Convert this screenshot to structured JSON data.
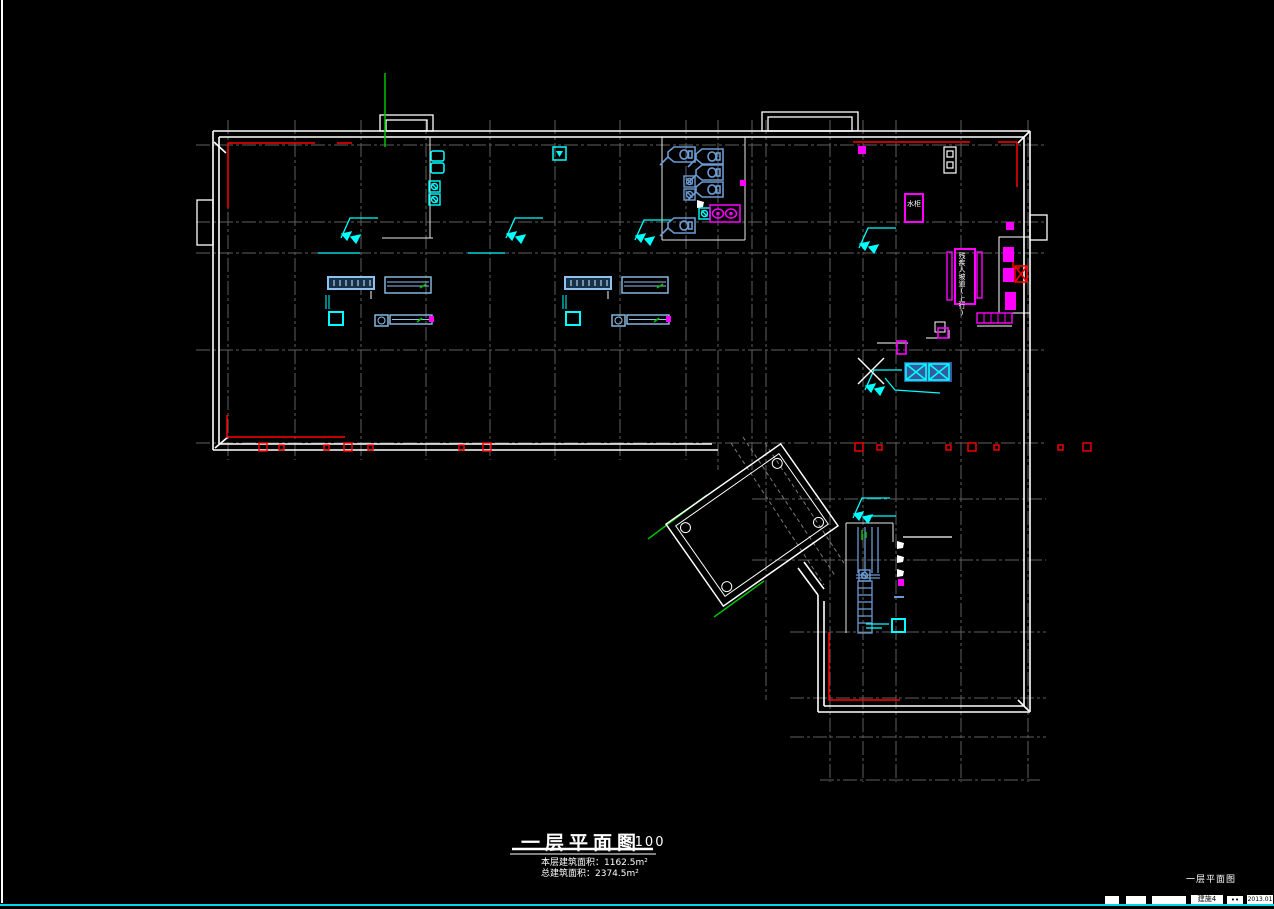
{
  "viewport": {
    "background": "#000000"
  },
  "plan": {
    "title": "一层平面图",
    "scale": "1:100",
    "area_line1": "本层建筑面积：1162.5m²",
    "area_line2": "总建筑面积：2374.5m²",
    "ramp_label": "残疾人坡道(上行)",
    "cabinet_label": "水柜"
  },
  "corner_note": "一层平面图",
  "titleblock": {
    "sheet": "建施4",
    "date": "2013.01"
  },
  "colors": {
    "wall": "#ffffff",
    "grid": "#5f5f5f",
    "accent_red": "#ff0000",
    "fixture_blue": "#6b9bd2",
    "cyan": "#00ffff",
    "magenta": "#ff00ff",
    "green": "#00c000",
    "statusbar_line": "#00d8e8"
  }
}
